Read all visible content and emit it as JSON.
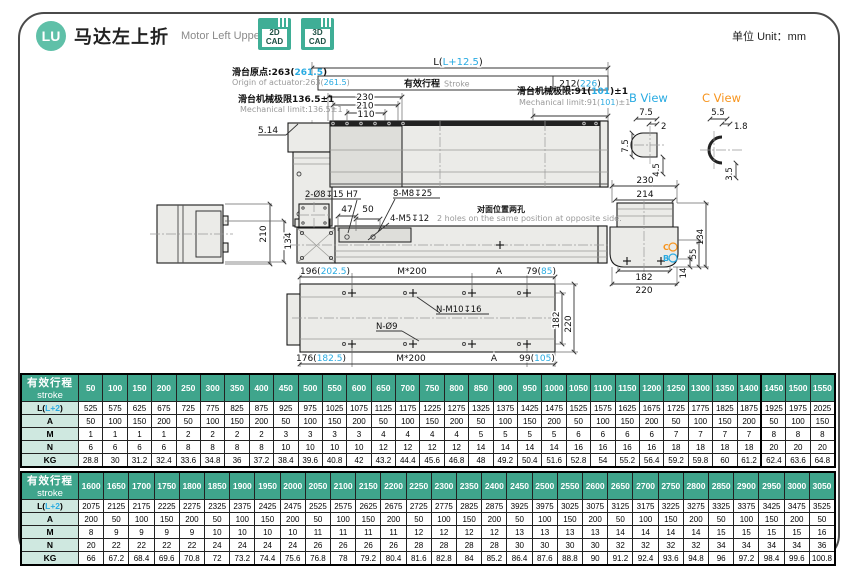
{
  "colors": {
    "teal": "#3fa58c",
    "teal_light": "#cfe8e0",
    "cyan": "#29abe2",
    "orange": "#f7941d"
  },
  "page": {
    "unit_label": "单位 Unit：mm"
  },
  "header": {
    "badge": "LU",
    "title_zh": "马达左上折",
    "title_en": "Motor Left Upper Side",
    "cad_buttons": [
      {
        "line1": "2D",
        "line2": "CAD"
      },
      {
        "line1": "3D",
        "line2": "CAD"
      }
    ]
  },
  "drawing": {
    "origin_zh": {
      "pre": "滑台原点:263(",
      "hl": "261.5",
      "post": ")"
    },
    "origin_en": {
      "pre": "Origin of actuator:263(",
      "hl": "261.5",
      "post": ")"
    },
    "mech_left_zh": "滑台机械极限136.5±1",
    "mech_left_en": "Mechanical limit:136.5±1",
    "mech_right_zh": {
      "pre": "滑台机械极限:91(",
      "hl": "101",
      "post": ")±1"
    },
    "mech_right_en": {
      "pre": "Mechanical limit:91(",
      "hl": "101",
      "post": ")±1"
    },
    "dim_L": {
      "pre": "L(",
      "hl": "L+12.5",
      "post": ")"
    },
    "stroke_zh": "有效行程",
    "stroke_en": "Stroke",
    "dim_212": {
      "pre": "212(",
      "hl": "226",
      "post": ")"
    },
    "dim_230": "230",
    "dim_210": "210",
    "dim_110": "110",
    "dim_514": "5.14",
    "label_2o8": "2-Ø8↧15 H7",
    "label_8m8": "8-M8↧25",
    "dim_47": "47",
    "dim_50": "50",
    "label_4m5": "4-M5↧12",
    "note_zh": "对面位置两孔",
    "note_en": "2 holes on the same position at opposite side.",
    "dim_210p": "210",
    "dim_134p": "134",
    "b_view": {
      "title": "B View",
      "d_top": "7.5",
      "d_right": "2",
      "d_left": "7.5",
      "d_bottom": "4.5"
    },
    "c_view": {
      "title": "C View",
      "d_top": "5.5",
      "d_right": "1.8",
      "d_bottom": "3.5"
    },
    "side": {
      "d230": "230",
      "d214": "214",
      "d134": "134",
      "d55": "55",
      "d14": "14",
      "d182": "182",
      "d220": "220",
      "mB": "B",
      "mC": "C"
    },
    "bottom": {
      "dim_196": {
        "pre": "196(",
        "hl": "202.5",
        "post": ")"
      },
      "m200_top": "M*200",
      "a_top": "A",
      "dim_79": {
        "pre": "79(",
        "hl": "85",
        "post": ")"
      },
      "label_nm10": "N-M10↧16",
      "label_no9": "N-Ø9",
      "d182": "182",
      "d220": "220",
      "dim_176": {
        "pre": "176(",
        "hl": "182.5",
        "post": ")"
      },
      "m200_bot": "M*200",
      "a_bot": "A",
      "dim_99": {
        "pre": "99(",
        "hl": "105",
        "post": ")"
      }
    }
  },
  "tables": {
    "table1": {
      "header_zh": "有效行程",
      "header_en": "stroke",
      "divider_after": 27,
      "strokes": [
        "50",
        "100",
        "150",
        "200",
        "250",
        "300",
        "350",
        "400",
        "450",
        "500",
        "550",
        "600",
        "650",
        "700",
        "750",
        "800",
        "850",
        "900",
        "950",
        "1000",
        "1050",
        "1100",
        "1150",
        "1200",
        "1250",
        "1300",
        "1350",
        "1400",
        "1450",
        "1500",
        "1550"
      ],
      "rows": [
        {
          "label": {
            "pre": "L(",
            "hl": "L+2",
            "post": ")"
          },
          "values": [
            "525",
            "575",
            "625",
            "675",
            "725",
            "775",
            "825",
            "875",
            "925",
            "975",
            "1025",
            "1075",
            "1125",
            "1175",
            "1225",
            "1275",
            "1325",
            "1375",
            "1425",
            "1475",
            "1525",
            "1575",
            "1625",
            "1675",
            "1725",
            "1775",
            "1825",
            "1875",
            "1925",
            "1975",
            "2025"
          ]
        },
        {
          "label": "A",
          "values": [
            "50",
            "100",
            "150",
            "200",
            "50",
            "100",
            "150",
            "200",
            "50",
            "100",
            "150",
            "200",
            "50",
            "100",
            "150",
            "200",
            "50",
            "100",
            "150",
            "200",
            "50",
            "100",
            "150",
            "200",
            "50",
            "100",
            "150",
            "200",
            "50",
            "100",
            "150"
          ]
        },
        {
          "label": "M",
          "values": [
            "1",
            "1",
            "1",
            "1",
            "2",
            "2",
            "2",
            "2",
            "3",
            "3",
            "3",
            "3",
            "4",
            "4",
            "4",
            "4",
            "5",
            "5",
            "5",
            "5",
            "6",
            "6",
            "6",
            "6",
            "7",
            "7",
            "7",
            "7",
            "8",
            "8",
            "8"
          ]
        },
        {
          "label": "N",
          "values": [
            "6",
            "6",
            "6",
            "6",
            "8",
            "8",
            "8",
            "8",
            "10",
            "10",
            "10",
            "10",
            "12",
            "12",
            "12",
            "12",
            "14",
            "14",
            "14",
            "14",
            "16",
            "16",
            "16",
            "16",
            "18",
            "18",
            "18",
            "18",
            "20",
            "20",
            "20"
          ]
        },
        {
          "label": "KG",
          "values": [
            "28.8",
            "30",
            "31.2",
            "32.4",
            "33.6",
            "34.8",
            "36",
            "37.2",
            "38.4",
            "39.6",
            "40.8",
            "42",
            "43.2",
            "44.4",
            "45.6",
            "46.8",
            "48",
            "49.2",
            "50.4",
            "51.6",
            "52.8",
            "54",
            "55.2",
            "56.4",
            "59.2",
            "59.8",
            "60",
            "61.2",
            "62.4",
            "63.6",
            "64.8"
          ]
        }
      ]
    },
    "table2": {
      "header_zh": "有效行程",
      "header_en": "stroke",
      "divider_after": -1,
      "strokes": [
        "1600",
        "1650",
        "1700",
        "1750",
        "1800",
        "1850",
        "1900",
        "1950",
        "2000",
        "2050",
        "2100",
        "2150",
        "2200",
        "2250",
        "2300",
        "2350",
        "2400",
        "2450",
        "2500",
        "2550",
        "2600",
        "2650",
        "2700",
        "2750",
        "2800",
        "2850",
        "2900",
        "2950",
        "3000",
        "3050"
      ],
      "rows": [
        {
          "label": {
            "pre": "L(",
            "hl": "L+2",
            "post": ")"
          },
          "values": [
            "2075",
            "2125",
            "2175",
            "2225",
            "2275",
            "2325",
            "2375",
            "2425",
            "2475",
            "2525",
            "2575",
            "2625",
            "2675",
            "2725",
            "2775",
            "2825",
            "2875",
            "3925",
            "3975",
            "3025",
            "3075",
            "3125",
            "3175",
            "3225",
            "3275",
            "3325",
            "3375",
            "3425",
            "3475",
            "3525"
          ]
        },
        {
          "label": "A",
          "values": [
            "200",
            "50",
            "100",
            "150",
            "200",
            "50",
            "100",
            "150",
            "200",
            "50",
            "100",
            "150",
            "200",
            "50",
            "100",
            "150",
            "200",
            "50",
            "100",
            "150",
            "200",
            "50",
            "100",
            "150",
            "200",
            "50",
            "100",
            "150",
            "200",
            "50"
          ]
        },
        {
          "label": "M",
          "values": [
            "8",
            "9",
            "9",
            "9",
            "9",
            "10",
            "10",
            "10",
            "10",
            "11",
            "11",
            "11",
            "11",
            "12",
            "12",
            "12",
            "12",
            "13",
            "13",
            "13",
            "13",
            "14",
            "14",
            "14",
            "14",
            "15",
            "15",
            "15",
            "15",
            "16"
          ]
        },
        {
          "label": "N",
          "values": [
            "20",
            "22",
            "22",
            "22",
            "22",
            "24",
            "24",
            "24",
            "24",
            "26",
            "26",
            "26",
            "26",
            "28",
            "28",
            "28",
            "28",
            "30",
            "30",
            "30",
            "30",
            "32",
            "32",
            "32",
            "32",
            "34",
            "34",
            "34",
            "34",
            "36"
          ]
        },
        {
          "label": "KG",
          "values": [
            "66",
            "67.2",
            "68.4",
            "69.6",
            "70.8",
            "72",
            "73.2",
            "74.4",
            "75.6",
            "76.8",
            "78",
            "79.2",
            "80.4",
            "81.6",
            "82.8",
            "84",
            "85.2",
            "86.4",
            "87.6",
            "88.8",
            "90",
            "91.2",
            "92.4",
            "93.6",
            "94.8",
            "96",
            "97.2",
            "98.4",
            "99.6",
            "100.8"
          ]
        }
      ]
    }
  }
}
